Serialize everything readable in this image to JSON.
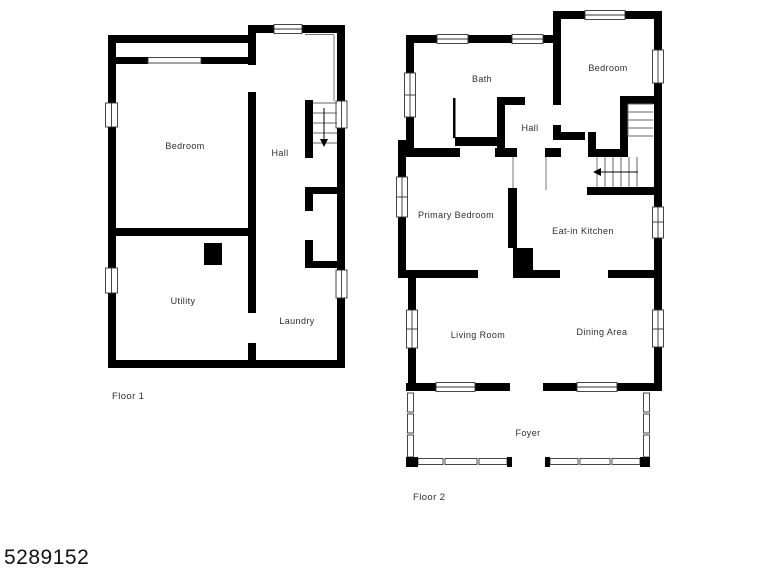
{
  "listing_id": "5289152",
  "colors": {
    "wall": "#000000",
    "label": "#2e2e2e",
    "background": "#ffffff"
  },
  "floors": [
    {
      "name": "Floor 1",
      "rooms": [
        {
          "label": "Bedroom"
        },
        {
          "label": "Hall"
        },
        {
          "label": "Utility"
        },
        {
          "label": "Laundry"
        }
      ]
    },
    {
      "name": "Floor 2",
      "rooms": [
        {
          "label": "Bath"
        },
        {
          "label": "Bedroom"
        },
        {
          "label": "Hall"
        },
        {
          "label": "Primary Bedroom"
        },
        {
          "label": "Eat-in Kitchen"
        },
        {
          "label": "Living Room"
        },
        {
          "label": "Dining Area"
        },
        {
          "label": "Foyer"
        }
      ]
    }
  ]
}
